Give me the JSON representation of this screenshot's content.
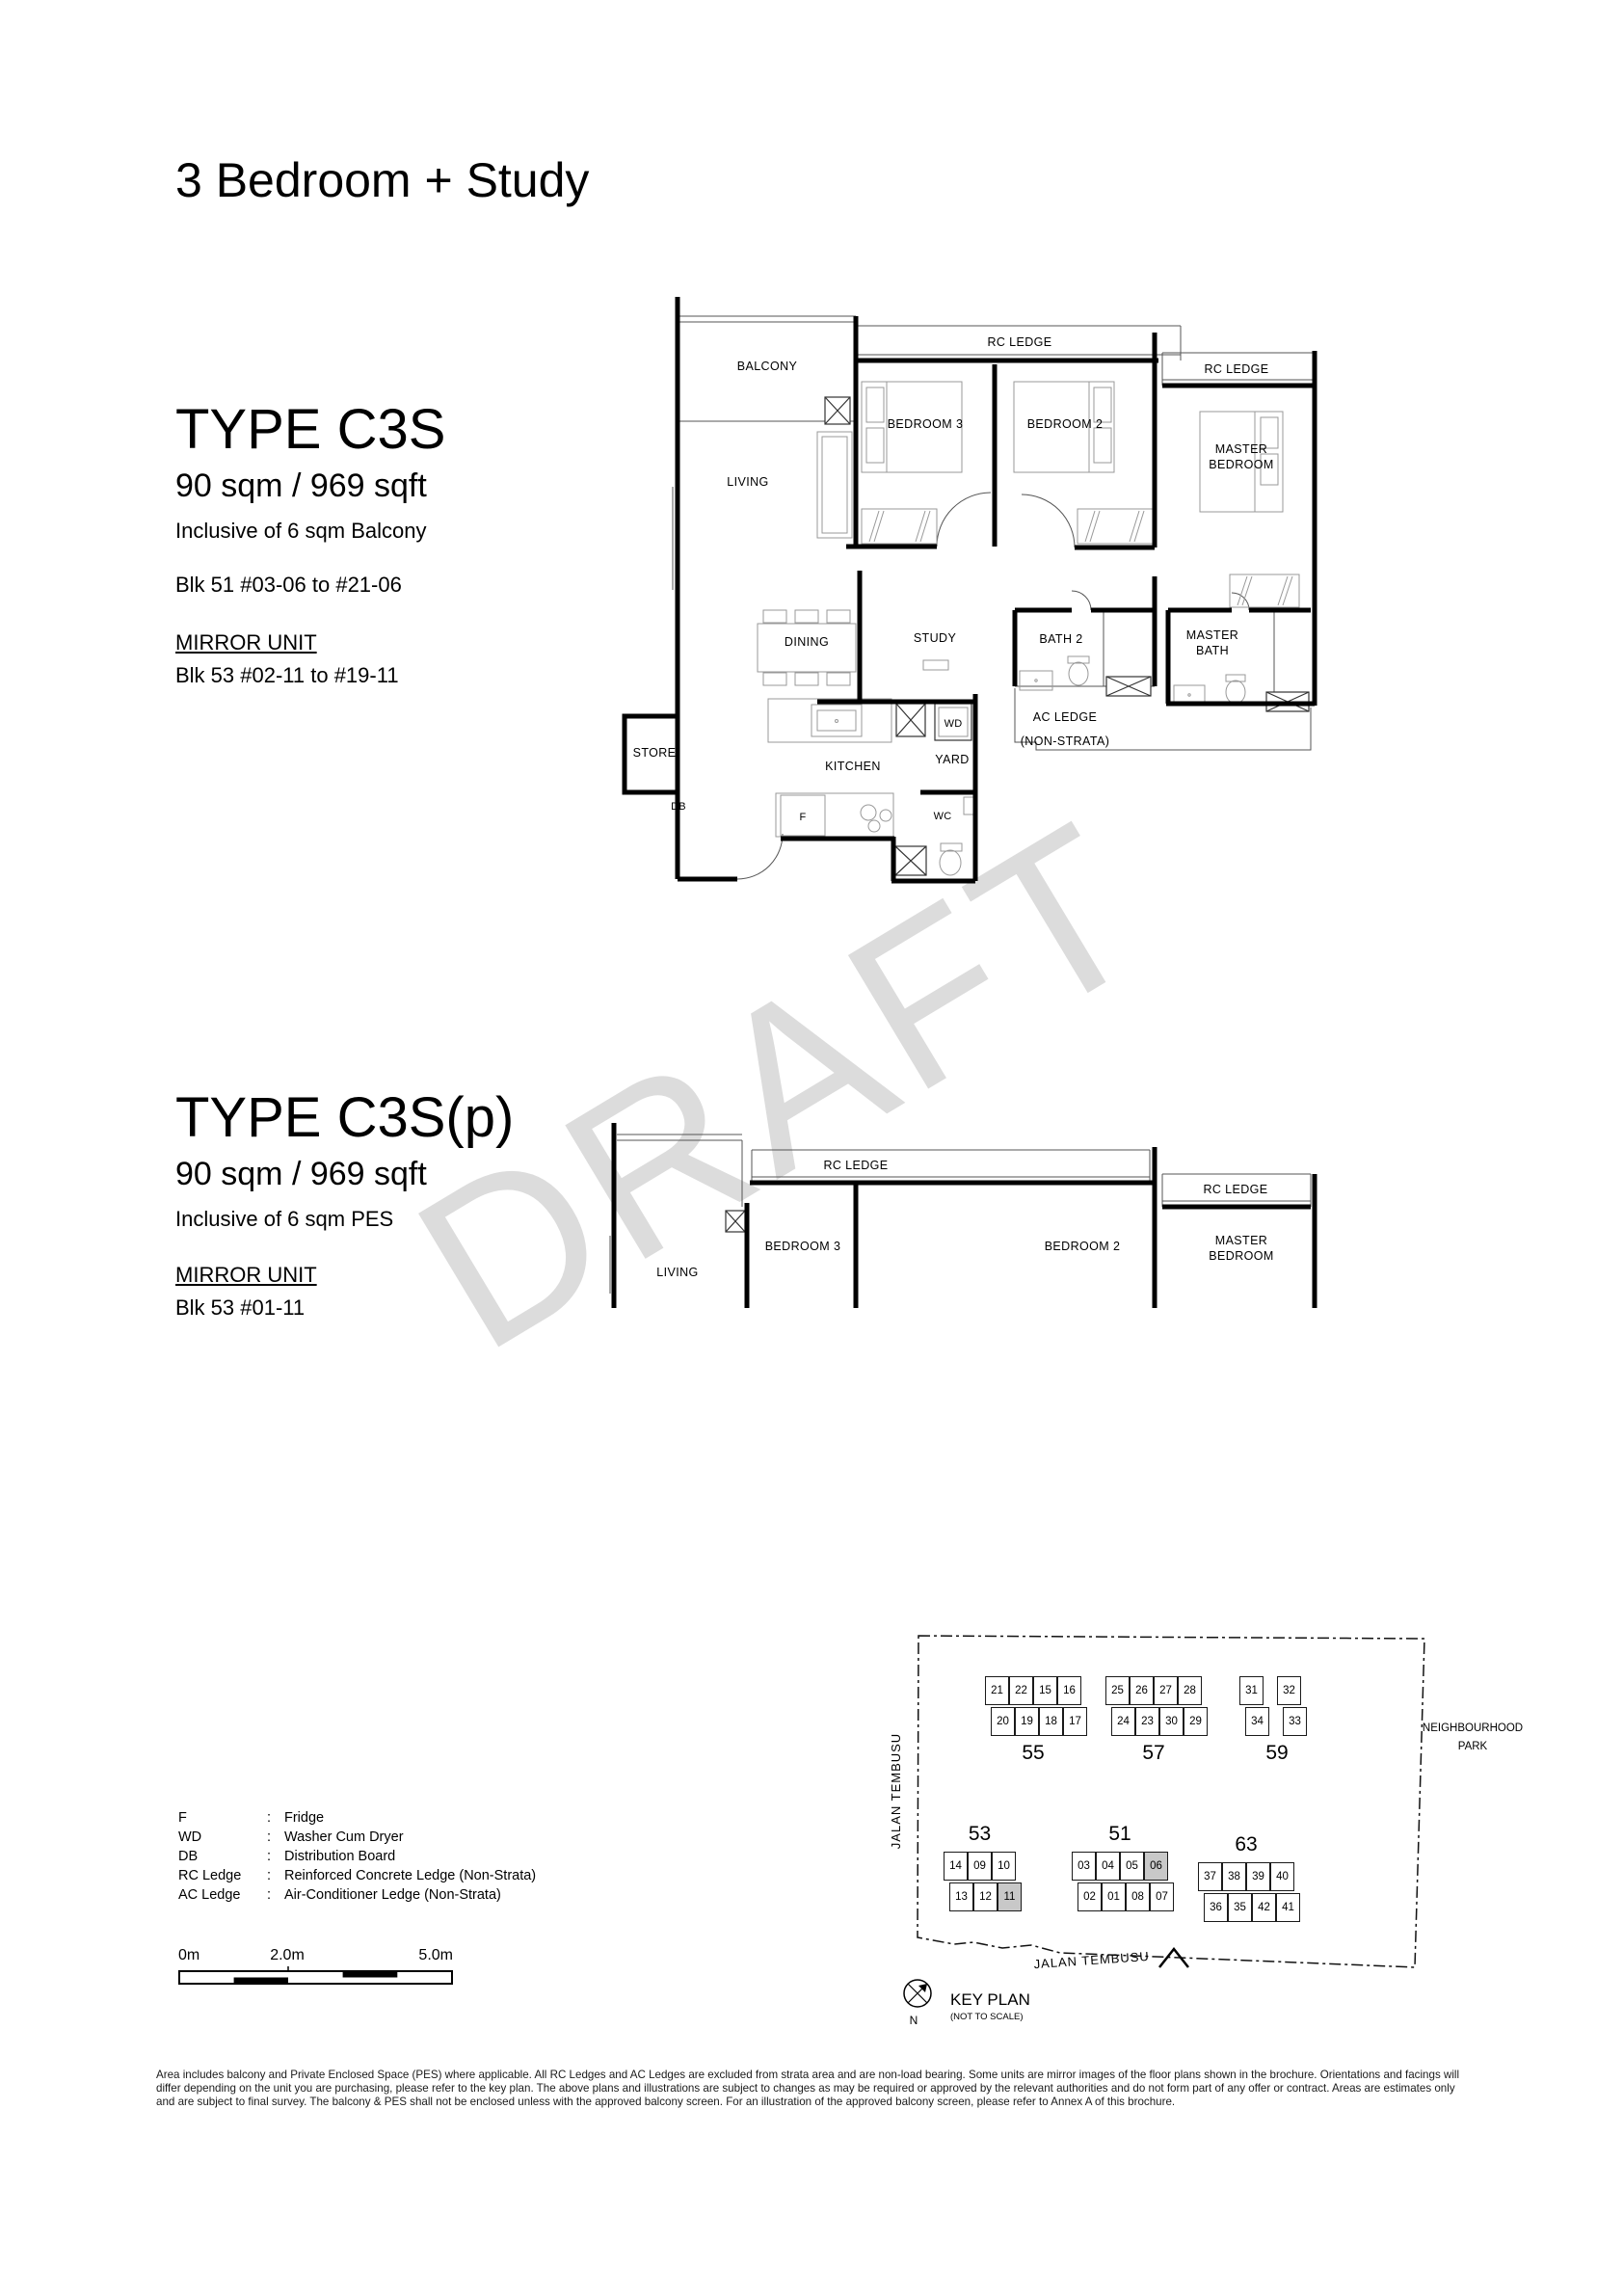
{
  "header": {
    "title": "3 Bedroom + Study"
  },
  "type_c3s": {
    "name": "TYPE C3S",
    "area": "90 sqm / 969 sqft",
    "inclusive": "Inclusive of 6 sqm Balcony",
    "blocks": "Blk 51 #03-06 to #21-06",
    "mirror_label": "MIRROR UNIT",
    "mirror_blocks": "Blk 53 #02-11 to #19-11"
  },
  "type_c3sp": {
    "name": "TYPE C3S(p)",
    "area": "90 sqm / 969 sqft",
    "inclusive": "Inclusive of 6 sqm PES",
    "mirror_label": "MIRROR UNIT",
    "mirror_blocks": "Blk 53 #01-11"
  },
  "watermark": "DRAFT",
  "rooms": {
    "balcony": "BALCONY",
    "living": "LIVING",
    "rc_ledge": "RC LEDGE",
    "bedroom3": "BEDROOM 3",
    "bedroom2": "BEDROOM 2",
    "master_bedroom": [
      "MASTER",
      "BEDROOM"
    ],
    "dining": "DINING",
    "study": "STUDY",
    "bath2": "BATH 2",
    "master_bath": [
      "MASTER",
      "BATH"
    ],
    "ac_ledge": [
      "AC LEDGE",
      "(NON-STRATA)"
    ],
    "store": "STORE",
    "db": "DB",
    "kitchen": "KITCHEN",
    "fridge": "F",
    "wd": "WD",
    "yard": "YARD",
    "wc": "WC"
  },
  "legend": {
    "items": [
      {
        "abbr": "F",
        "desc": "Fridge"
      },
      {
        "abbr": "WD",
        "desc": "Washer Cum Dryer"
      },
      {
        "abbr": "DB",
        "desc": "Distribution Board"
      },
      {
        "abbr": "RC Ledge",
        "desc": "Reinforced Concrete Ledge (Non-Strata)"
      },
      {
        "abbr": "AC Ledge",
        "desc": "Air-Conditioner Ledge (Non-Strata)"
      }
    ]
  },
  "scale_bar": {
    "start": "0m",
    "mid": "2.0m",
    "end": "5.0m"
  },
  "key_plan": {
    "title": "KEY PLAN",
    "subtitle": "(NOT TO SCALE)",
    "north_label": "N",
    "road_left": "JALAN TEMBUSU",
    "road_bottom": "JALAN TEMBUSU",
    "park": [
      "NEIGHBOURHOOD",
      "PARK"
    ],
    "blocks": [
      {
        "number": "55",
        "top": [
          "21",
          "22",
          "15",
          "16"
        ],
        "bottom": [
          "20",
          "19",
          "18",
          "17"
        ],
        "highlighted": []
      },
      {
        "number": "57",
        "top": [
          "25",
          "26",
          "27",
          "28"
        ],
        "bottom": [
          "24",
          "23",
          "30",
          "29"
        ],
        "highlighted": []
      },
      {
        "number": "59",
        "top": [
          "31",
          "32"
        ],
        "bottom": [
          "34",
          "33"
        ],
        "highlighted": []
      },
      {
        "number": "53",
        "top": [
          "14",
          "09",
          "10"
        ],
        "bottom": [
          "13",
          "12",
          "11"
        ],
        "highlighted": [
          "11"
        ]
      },
      {
        "number": "51",
        "top": [
          "03",
          "04",
          "05",
          "06"
        ],
        "bottom": [
          "02",
          "01",
          "08",
          "07"
        ],
        "highlighted": [
          "06"
        ]
      },
      {
        "number": "63",
        "top": [
          "37",
          "38",
          "39",
          "40"
        ],
        "bottom": [
          "36",
          "35",
          "42",
          "41"
        ],
        "highlighted": []
      }
    ]
  },
  "disclaimer": "Area includes balcony and Private Enclosed Space (PES) where applicable. All RC Ledges and AC Ledges are excluded from strata area and are non-load bearing. Some units are mirror images of the floor plans shown in the brochure. Orientations and facings will differ depending on the unit you are purchasing, please refer to the key plan. The above plans and illustrations are subject to changes as may be required or approved by the relevant authorities and do not form part of any offer or contract. Areas are estimates only and are subject to final survey. The balcony & PES shall not be enclosed unless with the approved balcony screen. For an illustration of the approved balcony screen, please refer to Annex A of this brochure."
}
